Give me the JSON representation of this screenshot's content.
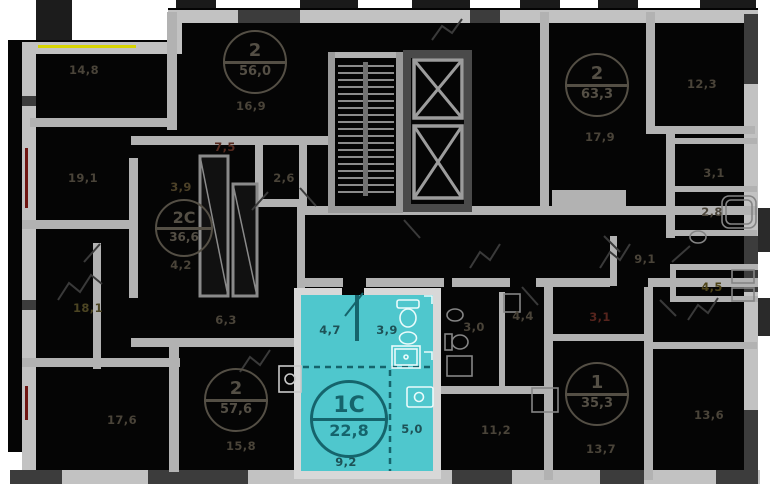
{
  "page": {
    "type": "residential floor plan",
    "floor_view": "typical floor with selected apartment"
  },
  "colors": {
    "page": "#ffffff",
    "building_fill": "#050505",
    "wall_outer": "#c2c2c2",
    "wall_inner": "#b2b2b2",
    "wall_dark": "#3c3c3c",
    "selected_fill": "#4fc7cd",
    "selected_line": "#15646c",
    "selected_text": "#1d5156",
    "label_default": "#4a4439",
    "accent_yellow": "#d6d400",
    "accent_red": "#6e1511"
  },
  "selected_unit": {
    "badge_type": "1С",
    "total_area": "22,8",
    "room_areas": {
      "hall": "4,7",
      "bathroom": "3,9",
      "kitchen": "5,0",
      "living": "9,2"
    }
  },
  "unit_badges": [
    {
      "type": "2",
      "area": "56,0",
      "x": 255,
      "y": 62,
      "d": 64,
      "theme": "dark"
    },
    {
      "type": "2С",
      "area": "36,6",
      "x": 184,
      "y": 228,
      "d": 58,
      "theme": "dark"
    },
    {
      "type": "2",
      "area": "57,6",
      "x": 236,
      "y": 400,
      "d": 64,
      "theme": "dark"
    },
    {
      "type": "2",
      "area": "63,3",
      "x": 597,
      "y": 85,
      "d": 64,
      "theme": "dark"
    },
    {
      "type": "1",
      "area": "35,3",
      "x": 597,
      "y": 394,
      "d": 64,
      "theme": "dark"
    },
    {
      "type": "1С",
      "area": "22,8",
      "x": 349,
      "y": 419,
      "d": 78,
      "theme": "cyan"
    }
  ],
  "room_labels": [
    {
      "t": "14,8",
      "x": 84,
      "y": 70
    },
    {
      "t": "16,9",
      "x": 251,
      "y": 106
    },
    {
      "t": "19,1",
      "x": 83,
      "y": 178
    },
    {
      "t": "18,1",
      "x": 88,
      "y": 308,
      "c": "#4c4523"
    },
    {
      "t": "17,6",
      "x": 122,
      "y": 420
    },
    {
      "t": "7,5",
      "x": 225,
      "y": 147,
      "c": "#582b20"
    },
    {
      "t": "3,9",
      "x": 181,
      "y": 187,
      "c": "#4c4128"
    },
    {
      "t": "4,2",
      "x": 181,
      "y": 265
    },
    {
      "t": "2,6",
      "x": 284,
      "y": 178
    },
    {
      "t": "6,3",
      "x": 226,
      "y": 320
    },
    {
      "t": "15,8",
      "x": 241,
      "y": 446
    },
    {
      "t": "17,9",
      "x": 600,
      "y": 137
    },
    {
      "t": "12,3",
      "x": 702,
      "y": 84
    },
    {
      "t": "3,1",
      "x": 714,
      "y": 173
    },
    {
      "t": "2,8",
      "x": 712,
      "y": 212
    },
    {
      "t": "9,1",
      "x": 645,
      "y": 259
    },
    {
      "t": "4,5",
      "x": 712,
      "y": 287,
      "c": "#4f4519"
    },
    {
      "t": "3,1",
      "x": 600,
      "y": 317,
      "c": "#56241d"
    },
    {
      "t": "3,0",
      "x": 474,
      "y": 327
    },
    {
      "t": "4,4",
      "x": 523,
      "y": 316
    },
    {
      "t": "11,2",
      "x": 496,
      "y": 430
    },
    {
      "t": "13,7",
      "x": 601,
      "y": 449
    },
    {
      "t": "13,6",
      "x": 709,
      "y": 415
    },
    {
      "t": "4,7",
      "x": 330,
      "y": 330,
      "c": "#1d5156"
    },
    {
      "t": "3,9",
      "x": 387,
      "y": 330,
      "c": "#1d5156"
    },
    {
      "t": "5,0",
      "x": 412,
      "y": 429,
      "c": "#1d5156"
    },
    {
      "t": "9,2",
      "x": 346,
      "y": 462,
      "c": "#1d5156"
    }
  ]
}
